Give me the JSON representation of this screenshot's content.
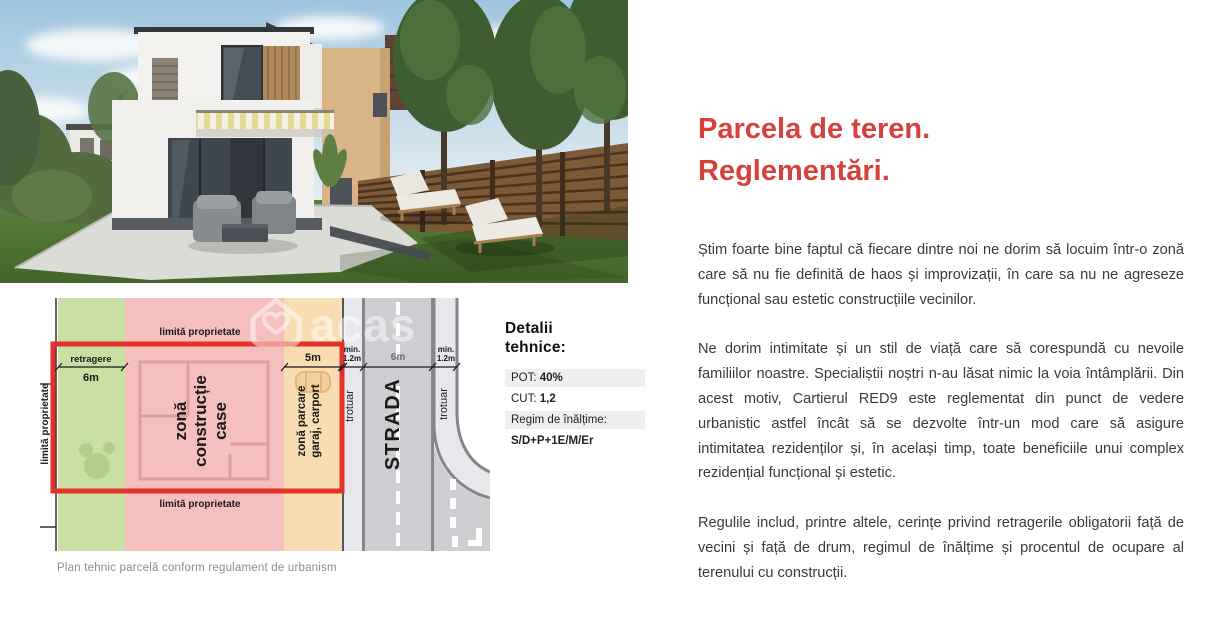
{
  "colors": {
    "accent": "#d6413c",
    "plan-green": "#cadfa4",
    "plan-pink": "#f5bfbd",
    "plan-orange": "#f8ddb2",
    "plan-red-outline": "#e23229",
    "plan-road": "#cdced2",
    "plan-sidewalk": "#e7e8eb"
  },
  "photo": {
    "alt": "Randare 3D casă modernă cu grădină"
  },
  "diagram": {
    "watermark_text": "acas",
    "caption": "Plan tehnic parcelă conform regulament de urbanism",
    "labels": {
      "limita_top": "limită proprietate",
      "limita_bottom": "limită proprietate",
      "limita_left": "limită proprietate",
      "retragere": "retragere",
      "retragere_dim": "6m",
      "zona_constructie_l1": "zonă",
      "zona_constructie_l2": "construcție",
      "zona_constructie_l3": "case",
      "zona_parcare_l1": "zonă parcare",
      "zona_parcare_l2": "garaj, carport",
      "parcare_dim": "5m",
      "sidewalk_min_left_l1": "min.",
      "sidewalk_min_left_l2": "1.2m",
      "street_dim": "6m",
      "sidewalk_min_right_l1": "min.",
      "sidewalk_min_right_l2": "1.2m",
      "trotuar_left": "trotuar",
      "trotuar_right": "trotuar",
      "strada": "STRADA"
    }
  },
  "tech_details": {
    "title_l1": "Detalii",
    "title_l2": "tehnice:",
    "pot_label": "POT:",
    "pot_value": "40%",
    "cut_label": "CUT:",
    "cut_value": "1,2",
    "regim_label": "Regim de înălțime:",
    "regim_value": "S/D+P+1E/M/Er"
  },
  "article": {
    "title_l1": "Parcela de teren.",
    "title_l2": "Reglementări.",
    "p1": "Știm foarte bine faptul că fiecare dintre noi ne dorim să locuim într-o zonă care să nu fie definită de haos și improvizații, în care sa nu ne agreseze funcțional sau estetic construcțiile vecinilor.",
    "p2": "Ne dorim intimitate și un stil de viață care să corespundă cu nevoile familiilor noastre. Specialiștii noștri n-au lăsat nimic la voia întâmplării. Din acest motiv, Cartierul RED9 este reglementat din punct de vedere urbanistic astfel încât să se dezvolte într-un mod care să asigure intimitatea rezidenților și, în același timp, toate beneficiile unui complex rezidențial funcțional și estetic.",
    "p3": "Regulile includ, printre altele, cerințe privind retragerile obligatorii față de vecini și față de drum, regimul de înălțime și procentul de ocupare al terenului cu construcții."
  }
}
